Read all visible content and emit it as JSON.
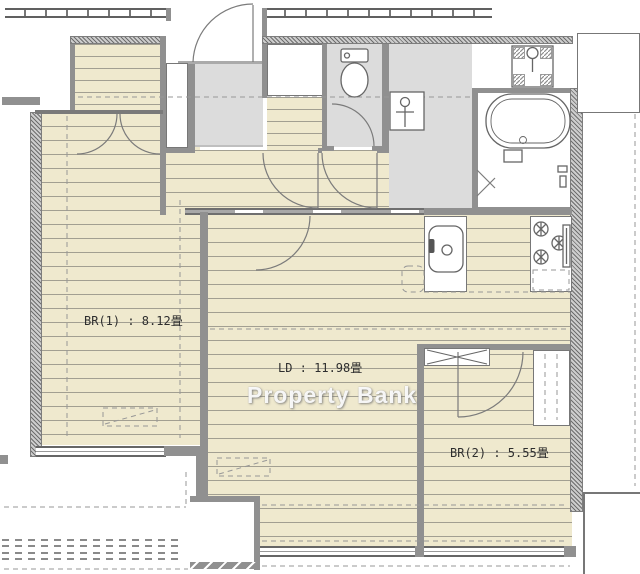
{
  "plan": {
    "type": "apartment-floor-plan",
    "rooms": [
      {
        "id": "br1",
        "label": "BR(1) : 8.12畳"
      },
      {
        "id": "ld",
        "label": "LD : 11.98畳"
      },
      {
        "id": "br2",
        "label": "BR(2) : 5.55畳"
      }
    ],
    "watermark": "Property Bank",
    "colors": {
      "wood": "#efe9ce",
      "floor_gray": "#dcdcdc",
      "wall": "#909090",
      "line": "#777777"
    },
    "fixtures": [
      "toilet-icon",
      "washbasin-icon",
      "washer-icon",
      "bathtub-icon",
      "kitchen-sink-icon",
      "gas-stove-icon",
      "entrance-door",
      "balcony"
    ]
  }
}
